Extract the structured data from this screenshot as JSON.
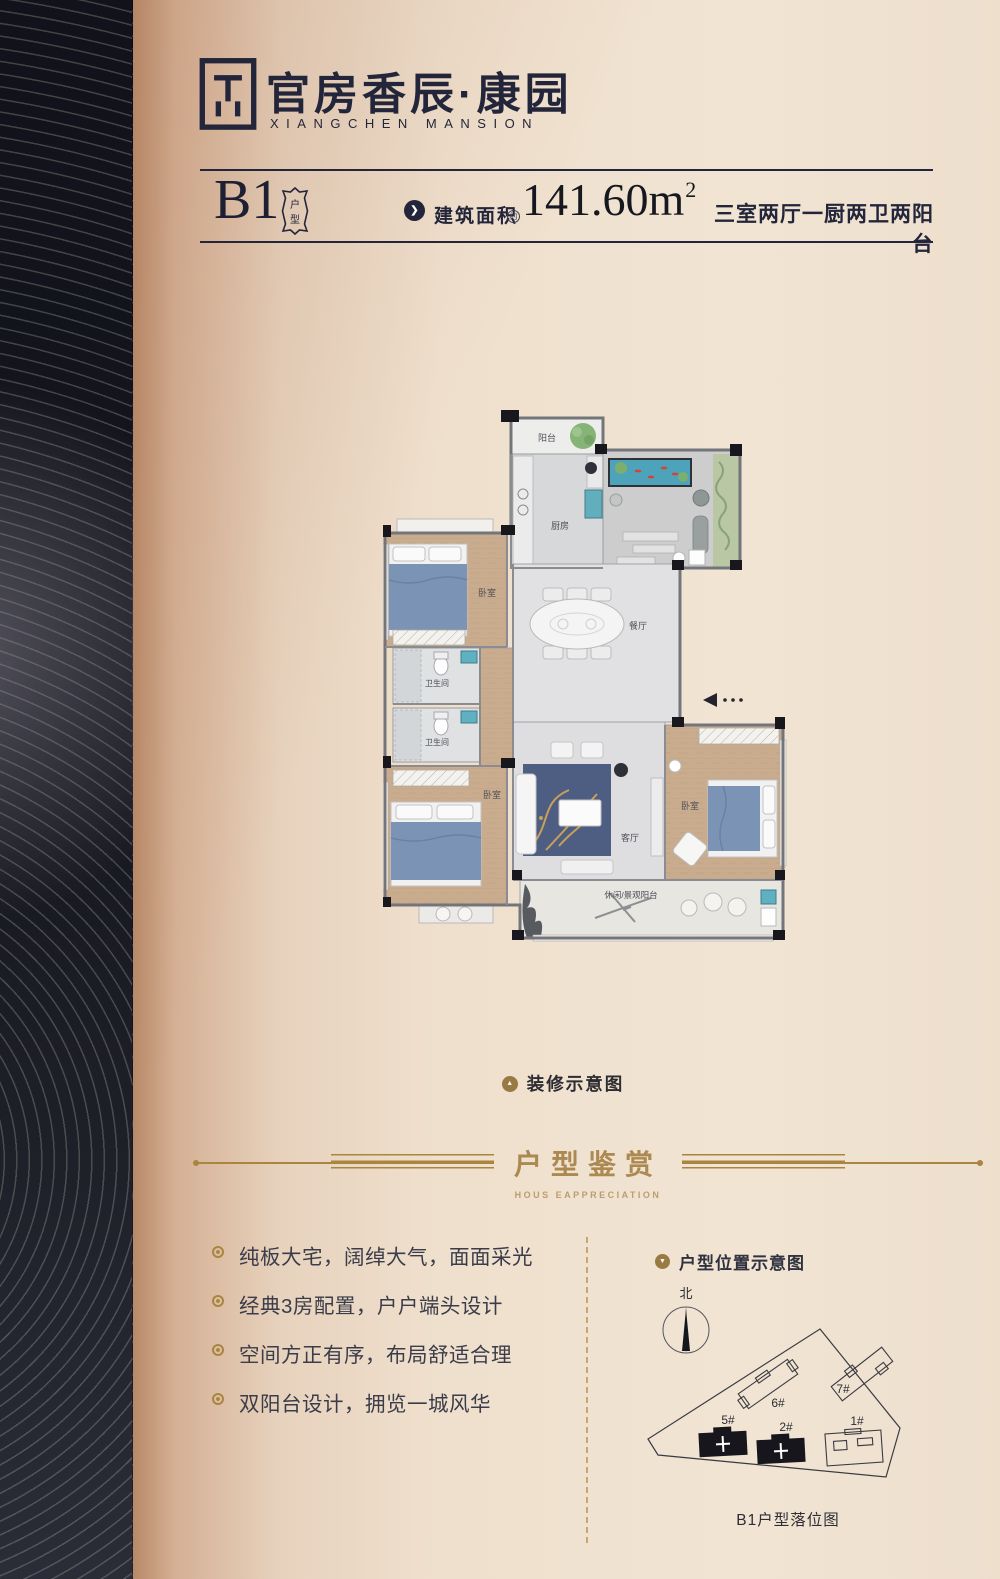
{
  "brand": {
    "name_cn": "官房香辰·康园",
    "name_en": "XIANGCHEN MANSION"
  },
  "unit": {
    "code": "B1",
    "badge": "户型",
    "badge_chars": [
      "户",
      "型"
    ],
    "area_label": "建筑面积",
    "area_approx": "约",
    "area_value": "141.60m",
    "area_exponent": "2",
    "layout_desc": "三室两厅一厨两卫两阳台"
  },
  "floorplan": {
    "caption": "装修示意图",
    "rooms": {
      "balcony": "阳台",
      "kitchen": "厨房",
      "bedroom1": "卧室",
      "dining": "餐厅",
      "bath1": "卫生间",
      "bath2": "卫生间",
      "bedroom2": "卧室",
      "living": "客厅",
      "bedroom3": "卧室",
      "view_balcony": "休闲/景观阳台"
    }
  },
  "section": {
    "title": "户型鉴赏",
    "subtitle": "HOUS EAPPRECIATION"
  },
  "features": [
    {
      "text": "纯板大宅，阔绰大气，面面采光"
    },
    {
      "text": "经典3房配置，户户端头设计"
    },
    {
      "text": "空间方正有序，布局舒适合理"
    },
    {
      "text": "双阳台设计，拥览一城风华"
    }
  ],
  "location": {
    "header": "户型位置示意图",
    "compass_north": "北",
    "buildings": [
      {
        "label": "5#",
        "highlighted": true
      },
      {
        "label": "2#",
        "highlighted": true
      },
      {
        "label": "6#",
        "highlighted": false
      },
      {
        "label": "7#",
        "highlighted": false
      },
      {
        "label": "1#",
        "highlighted": false
      }
    ],
    "caption": "B1户型落位图"
  },
  "icons": {
    "chevron": "❯",
    "triangle_up": "▲",
    "triangle_down": "▼"
  },
  "colors": {
    "navy": "#23263a",
    "gold": "#a9853f",
    "beige": "#efe0cd",
    "wood": "#c9ac8e",
    "pond": "#4da4ba",
    "rug": "#4e5d82",
    "highlight_building": "#16161c"
  }
}
